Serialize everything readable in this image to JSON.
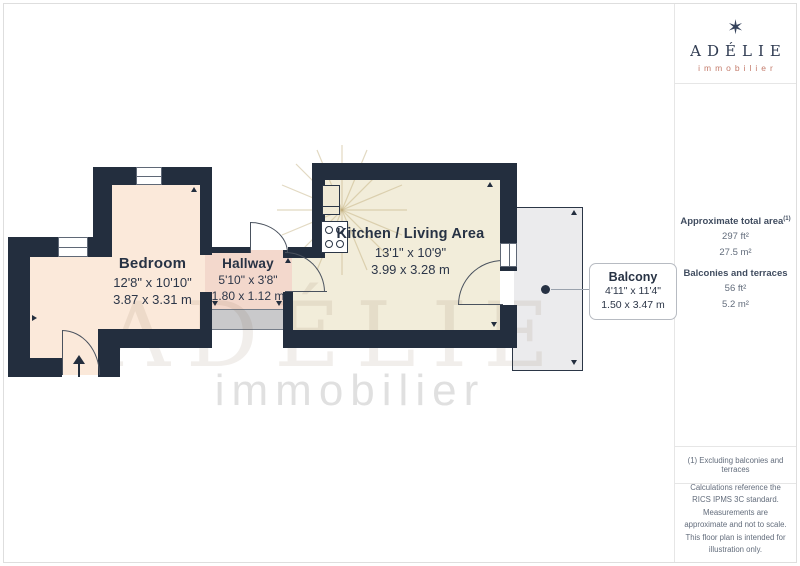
{
  "branding": {
    "star_icon": "✶",
    "logo_text": "ADÉLIE",
    "logo_subtext": "immobilier"
  },
  "sidebar": {
    "area_section": {
      "total_label": "Approximate total area",
      "total_sup": "(1)",
      "total_ft": "297 ft²",
      "total_m": "27.5 m²",
      "balcony_label": "Balconies and terraces",
      "balcony_ft": "56 ft²",
      "balcony_m": "5.2 m²"
    },
    "footnote": "(1) Excluding balconies and terraces",
    "disclaimer": "Calculations reference the RICS IPMS 3C standard. Measurements are approximate and not to scale. This floor plan is intended for illustration only.",
    "provider": "GIRAFFE",
    "provider_suffix": "360"
  },
  "floorplan": {
    "rooms": [
      {
        "name": "Bedroom",
        "dim_ft": "12'8\" x 10'10\"",
        "dim_m": "3.87 x 3.31 m"
      },
      {
        "name": "Hallway",
        "dim_ft": "5'10\" x 3'8\"",
        "dim_m": "1.80 x 1.12 m"
      },
      {
        "name": "Kitchen / Living Area",
        "dim_ft": "13'1\" x 10'9\"",
        "dim_m": "3.99 x 3.28 m"
      },
      {
        "name": "Balcony",
        "dim_ft": "4'11\" x 11'4\"",
        "dim_m": "1.50 x 3.47 m"
      }
    ],
    "watermark": {
      "line1": "ADÉLIE",
      "line2": "immobilier"
    },
    "colors": {
      "wall": "#232e3e",
      "bedroom_floor": "#fbe9da",
      "hallway_floor": "#f3d8cc",
      "kitchen_floor": "#f2edda",
      "balcony_floor": "#ebebed",
      "closet_gray": "#c9c9cb",
      "logo_navy": "#2e3a50",
      "logo_salmon": "#c47c6c"
    }
  }
}
